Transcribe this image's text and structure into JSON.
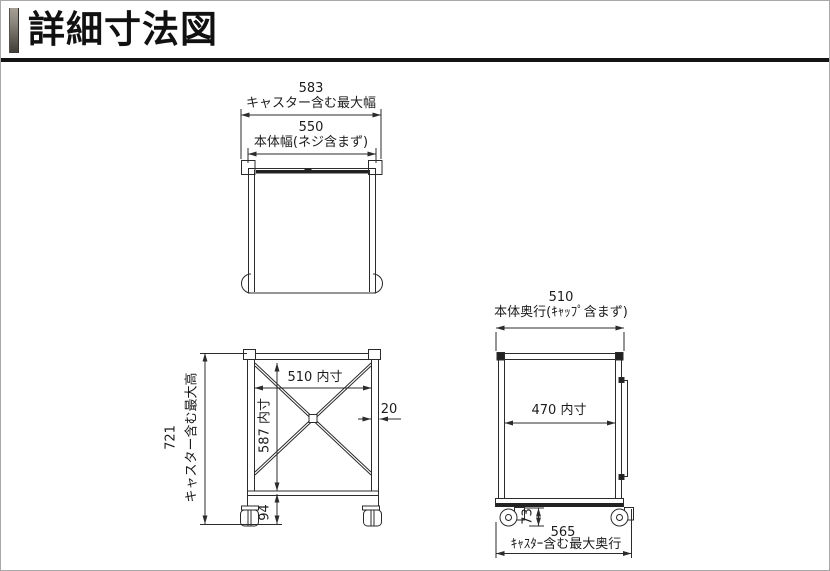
{
  "header": {
    "title": "詳細寸法図"
  },
  "top_view": {
    "max_width_value": "583",
    "max_width_label": "キャスター含む最大幅",
    "body_width_value": "550",
    "body_width_label": "本体幅(ネジ含まず)"
  },
  "front_view": {
    "max_height_value": "721",
    "max_height_label": "キャスター含む最大高",
    "inner_width": "510 内寸",
    "inner_height": "587 内寸",
    "frame_thickness": "20",
    "caster_height": "94"
  },
  "side_view": {
    "body_depth_value": "510",
    "body_depth_label": "本体奥行(ｷｬｯﾌﾟ含まず)",
    "inner_depth": "470 内寸",
    "caster_height": "73",
    "max_depth_value": "565",
    "max_depth_label": "ｷｬｽﾀｰ含む最大奥行"
  },
  "colors": {
    "line": "#2b2b2b",
    "dark_fill": "#222222",
    "header_underline": "#141414"
  }
}
